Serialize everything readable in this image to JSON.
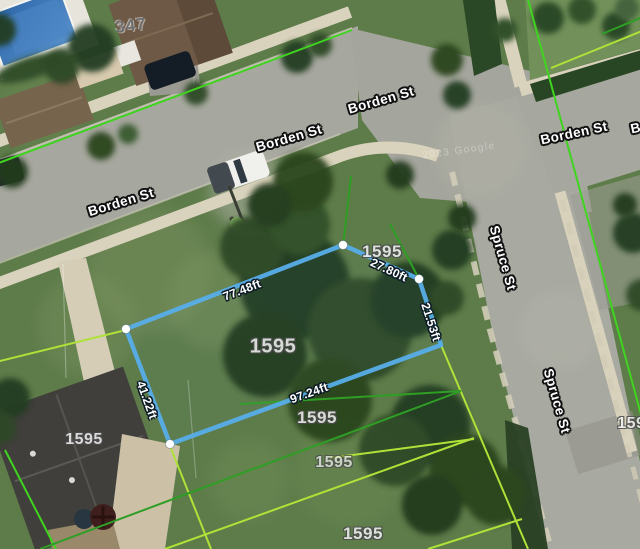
{
  "map": {
    "view": "satellite-parcel-measurement",
    "house_number": "347",
    "watermark": "2023 Google",
    "street_labels": [
      "Borden St",
      "Borden St",
      "Borden St",
      "Borden St",
      "Borden St",
      "Spruce St",
      "Spruce St"
    ],
    "parcel_labels": [
      "1595",
      "1595",
      "1595",
      "1595",
      "1595",
      "1595",
      "1595"
    ],
    "measurements": {
      "front": "77.48ft",
      "corner_cut": "27.80ft",
      "right_side": "21.53ft",
      "rear": "97.24ft",
      "left_side": "41.22ft"
    },
    "highlighted_parcel": {
      "id": "1595",
      "edge_lengths_ft": [
        77.48,
        27.8,
        21.53,
        97.24,
        41.22
      ],
      "outline_color": "#58aee9",
      "vertices": [
        {
          "x": 126,
          "y": 329
        },
        {
          "x": 343,
          "y": 245
        },
        {
          "x": 419,
          "y": 279
        },
        {
          "x": 441,
          "y": 345
        },
        {
          "x": 170,
          "y": 444
        }
      ]
    },
    "boundary_colors": {
      "bright_green": "#3fd41f",
      "yellow_green": "#aee238",
      "medium_green": "#2f9e25"
    },
    "surface_colors": {
      "road": "#a6a79e",
      "sidewalk": "#d9d2bc",
      "grass": "#5e7c4a",
      "tree": "#253e20",
      "pool": "#3371b3"
    }
  }
}
